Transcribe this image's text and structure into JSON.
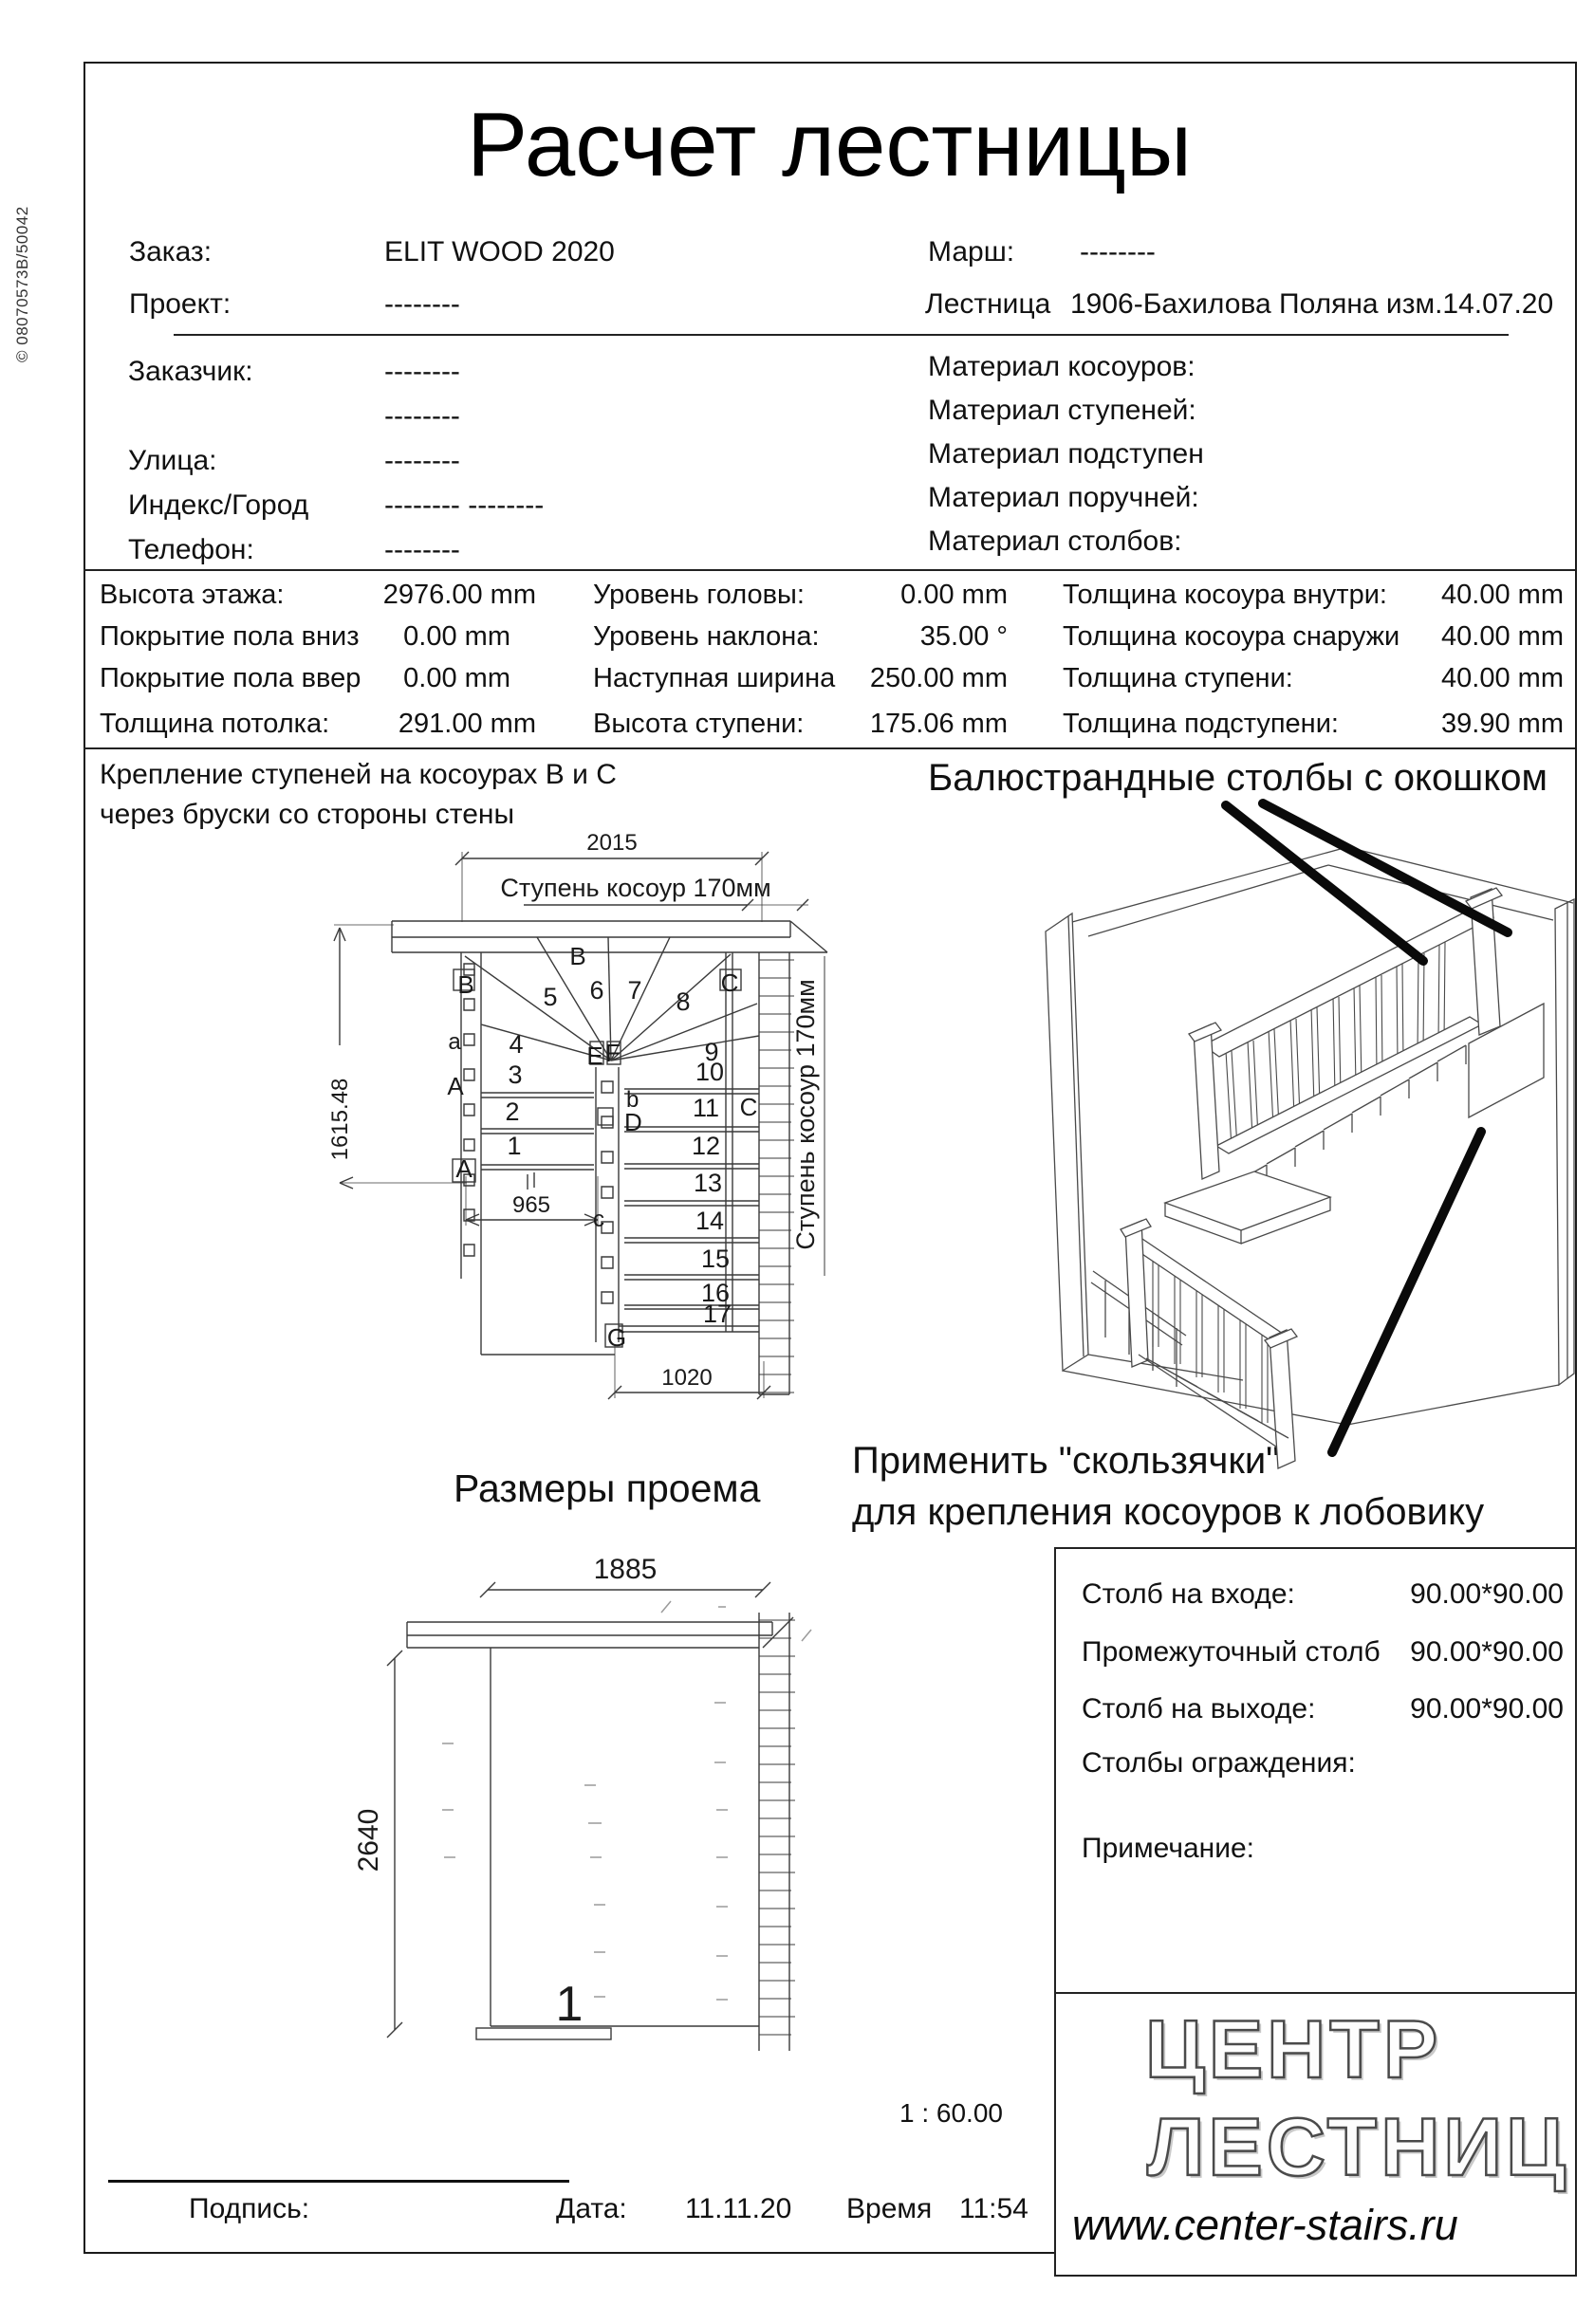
{
  "meta": {
    "side_code": "© 08070573B/50042",
    "scale": "1 : 60.00"
  },
  "title": "Расчет лестницы",
  "order": {
    "order_label": "Заказ:",
    "order_value": "ELIT WOOD 2020",
    "project_label": "Проект:",
    "project_value": "--------",
    "march_label": "Марш:",
    "march_value": "--------",
    "stair_label": "Лестница",
    "stair_value": "1906-Бахилова Поляна изм.14.07.20"
  },
  "client": {
    "rows": [
      {
        "label": "Заказчик:",
        "value": "--------"
      },
      {
        "label": "",
        "value": "--------"
      },
      {
        "label": "Улица:",
        "value": "--------"
      },
      {
        "label": "Индекс/Город",
        "value": "--------  --------"
      },
      {
        "label": "Телефон:",
        "value": "--------"
      }
    ]
  },
  "materials": {
    "rows": [
      "Материал косоуров:",
      "Материал ступеней:",
      "Материал подступен",
      "Материал поручней:",
      "Материал столбов:"
    ]
  },
  "params": {
    "col1": [
      {
        "label": "Высота этажа:",
        "value": "2976.00 mm"
      },
      {
        "label": "Покрытие пола вниз",
        "value": "0.00 mm"
      },
      {
        "label": "Покрытие пола ввер",
        "value": "0.00 mm"
      },
      {
        "label": "Толщина потолка:",
        "value": "291.00 mm"
      }
    ],
    "col2": [
      {
        "label": "Уровень головы:",
        "value": "0.00 mm"
      },
      {
        "label": "Уровень наклона:",
        "value": "35.00 °"
      },
      {
        "label": "Наступная ширина",
        "value": "250.00 mm"
      },
      {
        "label": "Высота ступени:",
        "value": "175.06 mm"
      }
    ],
    "col3": [
      {
        "label": "Толщина косоура внутри:",
        "value": "40.00 mm"
      },
      {
        "label": "Толщина косоура снаружи",
        "value": "40.00 mm"
      },
      {
        "label": "Толщина ступени:",
        "value": "40.00 mm"
      },
      {
        "label": "Толщина подступени:",
        "value": "39.90 mm"
      }
    ]
  },
  "notes": {
    "fixing_line1": "Крепление ступеней на косоурах B и C",
    "fixing_line2": "через бруски со стороны стены",
    "baluster": "Балюстрандные столбы с окошком",
    "slider_line1": "Применить \"скользячки\"",
    "slider_line2": "для крепления косоуров к лобовику"
  },
  "plan": {
    "dim_top": "2015",
    "dim_left": "1615.48",
    "dim_mid": "965",
    "dim_bottom": "1020",
    "stringer_label_h": "Ступень косоур 170мм",
    "stringer_label_v": "Ступень косоур 170мм",
    "steps": [
      "1",
      "2",
      "3",
      "4",
      "5",
      "6",
      "7",
      "8",
      "9",
      "10",
      "11",
      "12",
      "13",
      "14",
      "15",
      "16",
      "17"
    ],
    "letters": [
      "B",
      "B",
      "C",
      "a",
      "A",
      "A",
      "E",
      "F",
      "b",
      "D",
      "c",
      "G",
      "C"
    ]
  },
  "opening": {
    "title": "Размеры проема",
    "dim_width": "1885",
    "dim_height": "2640",
    "mark": "1"
  },
  "posts": {
    "rows": [
      {
        "label": "Столб на входе:",
        "value": "90.00*90.00"
      },
      {
        "label": "Промежуточный столб",
        "value": "90.00*90.00"
      },
      {
        "label": "Столб на выходе:",
        "value": "90.00*90.00"
      },
      {
        "label": "Столбы ограждения:",
        "value": ""
      },
      {
        "label": "Примечание:",
        "value": ""
      }
    ]
  },
  "footer": {
    "sign_label": "Подпись:",
    "date_label": "Дата:",
    "date_value": "11.11.20",
    "time_label": "Время",
    "time_value": "11:54"
  },
  "logo": {
    "line1": "ЦЕНТР",
    "line2": "ЛЕСТНИЦ",
    "url": "www.center-stairs.ru"
  }
}
